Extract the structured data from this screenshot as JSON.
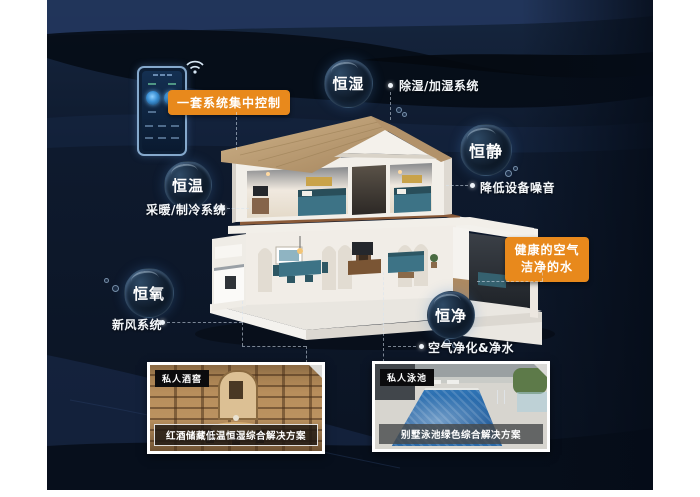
{
  "control_panel": {
    "badge_label": "一套系统集中控制"
  },
  "healthy_badge": {
    "line1": "健康的空气",
    "line2": "洁净的水"
  },
  "features": [
    {
      "bubble": "恒湿",
      "label": "除湿/加湿系统"
    },
    {
      "bubble": "恒静",
      "label": "降低设备噪音"
    },
    {
      "bubble": "恒温",
      "label": "采暖/制冷系统"
    },
    {
      "bubble": "恒氧",
      "label": "新风系统"
    },
    {
      "bubble": "恒净",
      "label": "空气净化&净水"
    }
  ],
  "solution_cards": [
    {
      "tag": "私人酒窖",
      "caption": "红酒储藏低温恒湿综合解决方案"
    },
    {
      "tag": "私人泳池",
      "caption": "别墅泳池绿色综合解决方案"
    }
  ],
  "colors": {
    "accent_orange": "#e8891c",
    "background_navy": "#0d1a2d",
    "bubble_dark": "#0a1420",
    "pool_blue": "#2f74b5",
    "wood_tan": "#b88e5c"
  }
}
